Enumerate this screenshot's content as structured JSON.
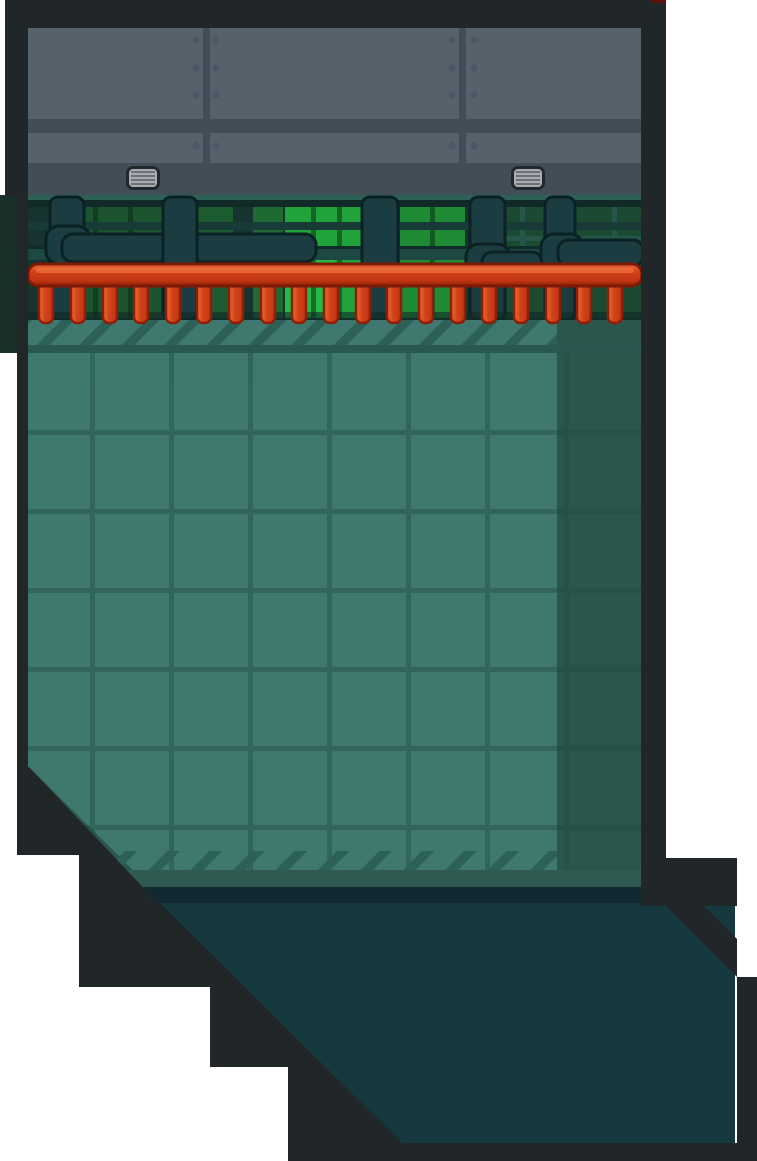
{
  "scene": {
    "title": "space-station room interior",
    "kind": "game-map-room",
    "counts": {
      "manifold_prongs": 19,
      "wall_vents": 2,
      "wall_rivet_columns": 4
    },
    "colors": {
      "page_bg": "#ffffff",
      "frame": "#212628",
      "accent_red_chip": "#5e100a",
      "left_block_green": "#1b2f2a",
      "wall_panel": "#55626c",
      "wall_band": "#414e58",
      "rivet": "#4a5765",
      "vent_frame": "#23282c",
      "vent_body": "#a9adb2",
      "vent_slat": "#6a7177",
      "window_bg": "#16332f",
      "window_ledge_light": "#2c5f55",
      "window_ledge_dark": "#112a27",
      "glass_dim": "#1c5430",
      "glass_dim2": "#1d5c30",
      "glass_mid": "#1e6a32",
      "glass_bright": "#21a33c",
      "glass_bright2": "#1f8c35",
      "glass_right_dim": "#1b4a31",
      "glass_glow": "#2abf4b",
      "mullion_dark": "rgba(8,38,20,0.50)",
      "mullion_teal": "#275a50",
      "rail_dark": "#193b37",
      "rail": "#1d4742",
      "rail_edge": "#102c29",
      "pipe": "#1b3c41",
      "pipe_edge": "#0b2225",
      "red_top": "#ef6b35",
      "red": "#d1421a",
      "red_mid": "#c23512",
      "red_deep": "#8f2106",
      "red_outline": "#7a1a07",
      "prong_outline": "#8c1f08",
      "red_highlight": "#f58048",
      "floor_light": "#3e786f",
      "floor_dark": "#2b564e",
      "floor_stripe": "#2d6057",
      "floor_edge": "#2a5750",
      "floor_band": "#2e5a52",
      "floor_navy": "#132931",
      "floor_grid": "#1e4a43",
      "shadow": "#16383f"
    }
  }
}
